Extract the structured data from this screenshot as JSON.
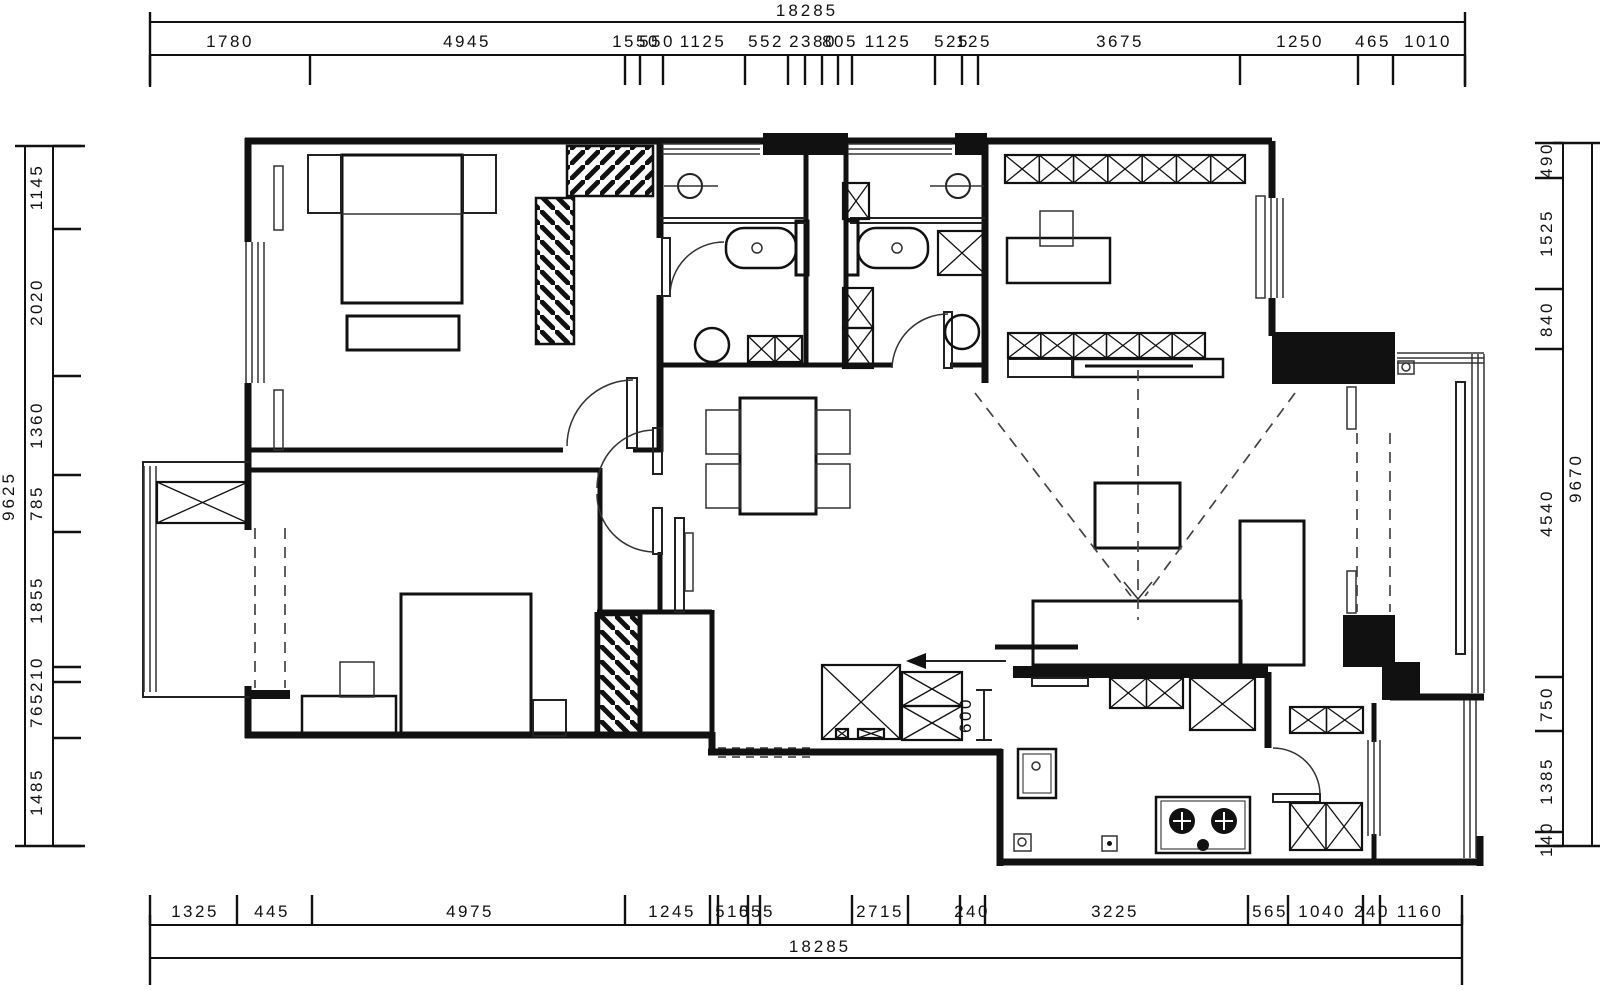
{
  "drawing": {
    "type": "residential-floor-plan",
    "units": "mm",
    "line_color": "#111111",
    "background": "#ffffff"
  },
  "interior": {
    "entry_depth": "600"
  },
  "dims": {
    "top": {
      "total": "18285",
      "start": 150,
      "end": 1465,
      "line_y": 55,
      "total_y": 22,
      "total_pos": 807,
      "ticks": [
        150,
        310,
        625,
        640,
        663,
        745,
        788,
        805,
        822,
        838,
        852,
        935,
        962,
        978,
        1240,
        1358,
        1393,
        1465
      ],
      "labels": [
        {
          "t": "1780",
          "p": 230
        },
        {
          "t": "4945",
          "p": 467
        },
        {
          "t": "1550",
          "p": 636
        },
        {
          "t": "550",
          "p": 657
        },
        {
          "t": "1125",
          "p": 703
        },
        {
          "t": "552",
          "p": 766
        },
        {
          "t": "2380",
          "p": 813
        },
        {
          "t": "805",
          "p": 840
        },
        {
          "t": "1125",
          "p": 888
        },
        {
          "t": "525",
          "p": 952
        },
        {
          "t": "125",
          "p": 974
        },
        {
          "t": "3675",
          "p": 1120
        },
        {
          "t": "1250",
          "p": 1300
        },
        {
          "t": "465",
          "p": 1373
        },
        {
          "t": "1010",
          "p": 1428
        }
      ]
    },
    "bottom": {
      "total": "18285",
      "start": 150,
      "end": 1462,
      "line_y": 925,
      "total_y": 958,
      "total_pos": 820,
      "ticks": [
        150,
        237,
        312,
        625,
        710,
        718,
        748,
        760,
        852,
        908,
        960,
        985,
        1248,
        1288,
        1363,
        1380,
        1462
      ],
      "labels": [
        {
          "t": "1325",
          "p": 195
        },
        {
          "t": "445",
          "p": 272
        },
        {
          "t": "4975",
          "p": 470
        },
        {
          "t": "1245",
          "p": 672
        },
        {
          "t": "510",
          "p": 733
        },
        {
          "t": "555",
          "p": 757
        },
        {
          "t": "2715",
          "p": 880
        },
        {
          "t": "240",
          "p": 972
        },
        {
          "t": "3225",
          "p": 1115
        },
        {
          "t": "565",
          "p": 1270
        },
        {
          "t": "1040",
          "p": 1322
        },
        {
          "t": "240",
          "p": 1372
        },
        {
          "t": "1160",
          "p": 1420
        }
      ]
    },
    "left": {
      "total": "9625",
      "start": 146,
      "end": 846,
      "line_x": 53,
      "total_x": 25,
      "total_pos": 496,
      "ticks": [
        146,
        229,
        376,
        475,
        532,
        667,
        682,
        738,
        846
      ],
      "labels": [
        {
          "t": "1145",
          "p": 187
        },
        {
          "t": "2020",
          "p": 302
        },
        {
          "t": "1360",
          "p": 425
        },
        {
          "t": "785",
          "p": 503
        },
        {
          "t": "1855",
          "p": 600
        },
        {
          "t": "210",
          "p": 674
        },
        {
          "t": "765",
          "p": 710
        },
        {
          "t": "1485",
          "p": 792
        }
      ]
    },
    "right": {
      "total": "9670",
      "start": 143,
      "end": 846,
      "line_x": 1563,
      "total_x": 1592,
      "total_pos": 478,
      "ticks": [
        143,
        178,
        289,
        349,
        677,
        731,
        832,
        846
      ],
      "labels": [
        {
          "t": "490",
          "p": 160
        },
        {
          "t": "1525",
          "p": 233
        },
        {
          "t": "840",
          "p": 319
        },
        {
          "t": "4540",
          "p": 513
        },
        {
          "t": "750",
          "p": 704
        },
        {
          "t": "1385",
          "p": 781
        },
        {
          "t": "140",
          "p": 839
        }
      ]
    }
  }
}
